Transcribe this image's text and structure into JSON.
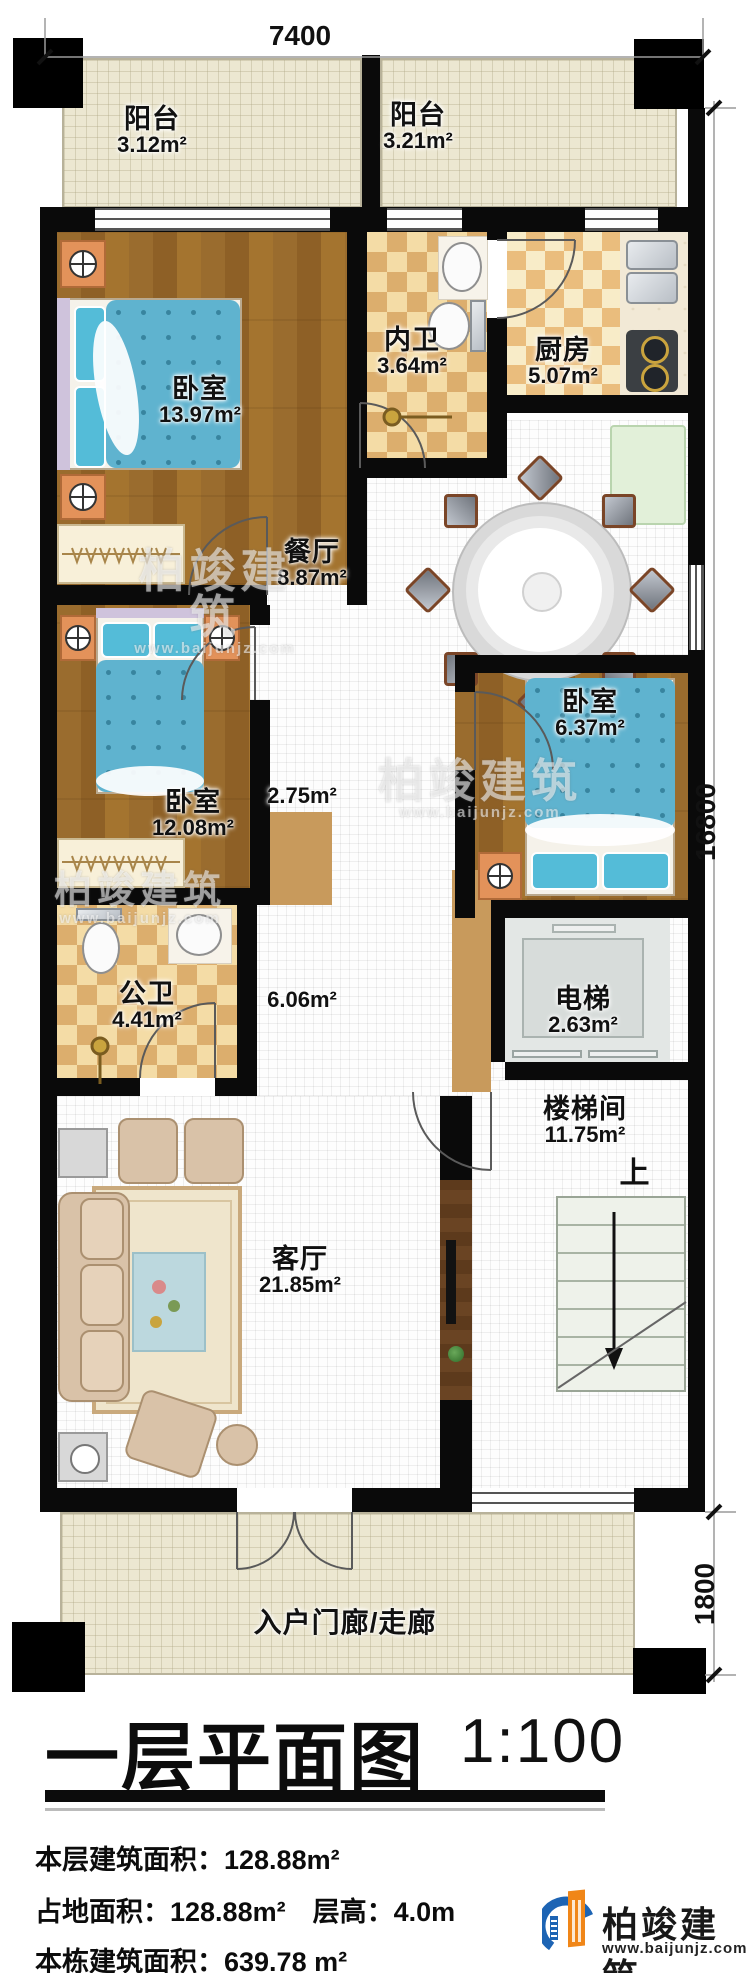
{
  "meta": {
    "drawing_type": "floor-plan"
  },
  "dimensions": {
    "top": "7400",
    "right_main": "16800",
    "right_lower": "1800"
  },
  "rooms": [
    {
      "id": "balcony-left",
      "name": "阳台",
      "area": "3.12m²"
    },
    {
      "id": "balcony-right",
      "name": "阳台",
      "area": "3.21m²"
    },
    {
      "id": "bedroom-1",
      "name": "卧室",
      "area": "13.97m²"
    },
    {
      "id": "inner-bath",
      "name": "内卫",
      "area": "3.64m²"
    },
    {
      "id": "kitchen",
      "name": "厨房",
      "area": "5.07m²"
    },
    {
      "id": "dining",
      "name": "餐厅",
      "area": "8.87m²"
    },
    {
      "id": "bedroom-3",
      "name": "卧室",
      "area": "6.37m²"
    },
    {
      "id": "bedroom-2",
      "name": "卧室",
      "area": "12.08m²"
    },
    {
      "id": "corridor",
      "name": "",
      "area": "2.75m²"
    },
    {
      "id": "public-bath",
      "name": "公卫",
      "area": "4.41m²"
    },
    {
      "id": "hall",
      "name": "",
      "area": "6.06m²"
    },
    {
      "id": "elevator",
      "name": "电梯",
      "area": "2.63m²"
    },
    {
      "id": "stairwell",
      "name": "楼梯间",
      "area": "11.75m²"
    },
    {
      "id": "living",
      "name": "客厅",
      "area": "21.85m²"
    },
    {
      "id": "entrance",
      "name": "入户门廊/走廊",
      "area": ""
    }
  ],
  "annotations": {
    "stairs_up": "上"
  },
  "title_block": {
    "title": "一层平面图",
    "scale": "1:100",
    "stats": [
      "本层建筑面积：128.88m²",
      "占地面积：128.88m²　层高：4.0m",
      "本栋建筑面积：639.78 m²"
    ]
  },
  "branding": {
    "name": "柏竣建筑",
    "url": "www.baijunjz.com",
    "colors": {
      "blue": "#1d64b4",
      "orange": "#f08618",
      "wall": "#0a0a0a"
    }
  }
}
